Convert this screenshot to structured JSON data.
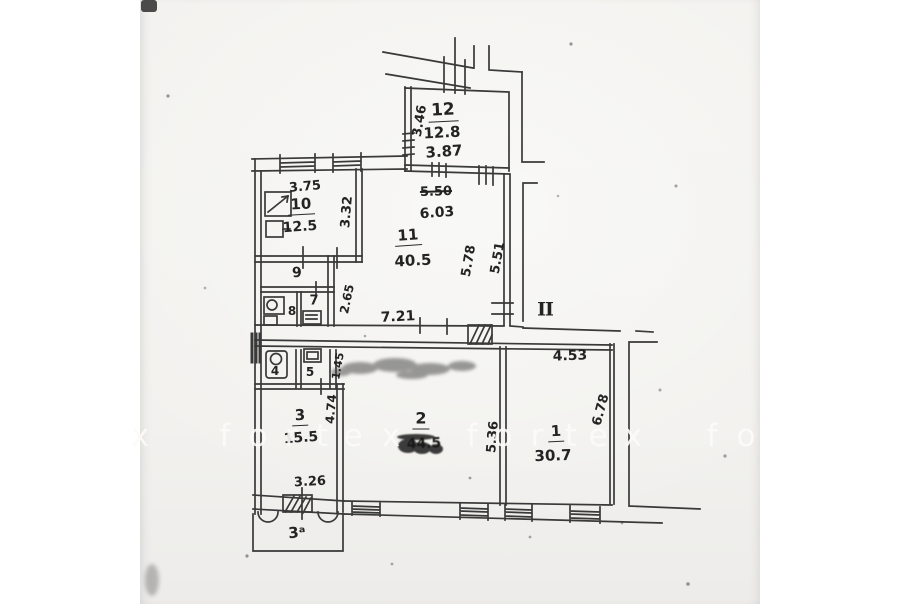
{
  "document": {
    "type_label": "apartment floor plan (scan)",
    "entrance_mark": "II",
    "balcony_mark": "3ᵃ"
  },
  "rooms": [
    {
      "number": "12",
      "area": "12.8"
    },
    {
      "number": "10",
      "area": "12.5"
    },
    {
      "number": "11",
      "area": "40.5"
    },
    {
      "number": "9",
      "area": ""
    },
    {
      "number": "8",
      "area": ""
    },
    {
      "number": "7",
      "area": ""
    },
    {
      "number": "4",
      "area": ""
    },
    {
      "number": "5",
      "area": ""
    },
    {
      "number": "3",
      "area": "15.5"
    },
    {
      "number": "2",
      "area": "44.5",
      "smudged": true
    },
    {
      "number": "1",
      "area": "30.7"
    }
  ],
  "plan": {
    "labels": [
      {
        "name": "dim-3-46",
        "text": "3.46",
        "x": 420,
        "y": 121,
        "rot": -80,
        "size": 13
      },
      {
        "name": "room-12-number",
        "text": "12",
        "x": 443,
        "y": 112,
        "rot": -3,
        "size": 17,
        "cls": "underline"
      },
      {
        "name": "room-12-area",
        "text": "12.8",
        "x": 442,
        "y": 133,
        "rot": -3,
        "size": 15
      },
      {
        "name": "dim-3-87",
        "text": "3.87",
        "x": 444,
        "y": 152,
        "rot": -4,
        "size": 15
      },
      {
        "name": "dim-5-50",
        "text": "5.50",
        "x": 436,
        "y": 192,
        "rot": -2,
        "size": 13,
        "cls": "strike"
      },
      {
        "name": "dim-6-03",
        "text": "6.03",
        "x": 437,
        "y": 213,
        "rot": -4,
        "size": 14
      },
      {
        "name": "dim-3-75",
        "text": "3.75",
        "x": 305,
        "y": 187,
        "rot": -5,
        "size": 13
      },
      {
        "name": "room-10-number",
        "text": "10",
        "x": 301,
        "y": 206,
        "rot": -3,
        "size": 15,
        "cls": "underline"
      },
      {
        "name": "room-10-area",
        "text": "12.5",
        "x": 300,
        "y": 227,
        "rot": -4,
        "size": 14
      },
      {
        "name": "dim-3-32",
        "text": "3.32",
        "x": 347,
        "y": 212,
        "rot": -85,
        "size": 13
      },
      {
        "name": "room-9-number",
        "text": "9",
        "x": 297,
        "y": 273,
        "rot": -5,
        "size": 14
      },
      {
        "name": "room-7-number",
        "text": "7",
        "x": 314,
        "y": 301,
        "rot": 0,
        "size": 13
      },
      {
        "name": "room-8-number",
        "text": "8",
        "x": 292,
        "y": 311,
        "rot": 0,
        "size": 12
      },
      {
        "name": "dim-2-65",
        "text": "2.65",
        "x": 347,
        "y": 299,
        "rot": -78,
        "size": 12
      },
      {
        "name": "room-11-number",
        "text": "11",
        "x": 408,
        "y": 237,
        "rot": -4,
        "size": 15,
        "cls": "underline"
      },
      {
        "name": "room-11-area",
        "text": "40.5",
        "x": 413,
        "y": 261,
        "rot": -3,
        "size": 15
      },
      {
        "name": "dim-5-78",
        "text": "5.78",
        "x": 469,
        "y": 261,
        "rot": -80,
        "size": 13
      },
      {
        "name": "dim-5-51",
        "text": "5.51",
        "x": 498,
        "y": 258,
        "rot": -80,
        "size": 13
      },
      {
        "name": "dim-7-21",
        "text": "7.21",
        "x": 398,
        "y": 317,
        "rot": -3,
        "size": 14
      },
      {
        "name": "entrance-ii-label",
        "text": "II",
        "x": 545,
        "y": 310,
        "rot": 0,
        "size": 19,
        "cls": "serif"
      },
      {
        "name": "dim-4-53",
        "text": "4.53",
        "x": 570,
        "y": 356,
        "rot": -2,
        "size": 14
      },
      {
        "name": "room-1-number",
        "text": "1",
        "x": 556,
        "y": 433,
        "rot": -3,
        "size": 15,
        "cls": "underline"
      },
      {
        "name": "room-1-area",
        "text": "30.7",
        "x": 553,
        "y": 456,
        "rot": -2,
        "size": 15
      },
      {
        "name": "dim-6-78",
        "text": "6.78",
        "x": 601,
        "y": 410,
        "rot": -75,
        "size": 13
      },
      {
        "name": "dim-5-36",
        "text": "5.36",
        "x": 493,
        "y": 437,
        "rot": -85,
        "size": 13
      },
      {
        "name": "room-2-number",
        "text": "2",
        "x": 421,
        "y": 420,
        "rot": 0,
        "size": 16,
        "cls": "underline"
      },
      {
        "name": "room-2-area",
        "text": "44.5",
        "x": 424,
        "y": 444,
        "rot": -2,
        "size": 14,
        "cls": "blotted"
      },
      {
        "name": "room-3-number",
        "text": "3",
        "x": 300,
        "y": 417,
        "rot": -3,
        "size": 15,
        "cls": "underline"
      },
      {
        "name": "room-3-area",
        "text": "15.5",
        "x": 301,
        "y": 438,
        "rot": -4,
        "size": 14
      },
      {
        "name": "dim-4-74",
        "text": "4.74",
        "x": 331,
        "y": 409,
        "rot": -85,
        "size": 12
      },
      {
        "name": "dim-1-45",
        "text": "1.45",
        "x": 338,
        "y": 366,
        "rot": -80,
        "size": 11
      },
      {
        "name": "dim-3-26",
        "text": "3.26",
        "x": 310,
        "y": 482,
        "rot": -3,
        "size": 13
      },
      {
        "name": "balcony-label",
        "text": "3ᵃ",
        "x": 297,
        "y": 533,
        "rot": -5,
        "size": 15
      },
      {
        "name": "room-4-number",
        "text": "4",
        "x": 275,
        "y": 371,
        "rot": 0,
        "size": 12
      },
      {
        "name": "room-5-number",
        "text": "5",
        "x": 310,
        "y": 372,
        "rot": 0,
        "size": 12
      }
    ]
  },
  "watermark": {
    "text": "fortex",
    "letters": [
      {
        "ch": "x",
        "x": 140
      },
      {
        "ch": "f",
        "x": 225
      },
      {
        "ch": "o",
        "x": 258
      },
      {
        "ch": "r",
        "x": 291
      },
      {
        "ch": "t",
        "x": 322
      },
      {
        "ch": "e",
        "x": 353
      },
      {
        "ch": "x",
        "x": 391
      },
      {
        "ch": "f",
        "x": 472
      },
      {
        "ch": "o",
        "x": 503
      },
      {
        "ch": "r",
        "x": 537
      },
      {
        "ch": "t",
        "x": 571
      },
      {
        "ch": "e",
        "x": 598
      },
      {
        "ch": "x",
        "x": 633
      },
      {
        "ch": "f",
        "x": 712
      },
      {
        "ch": "o",
        "x": 746
      }
    ]
  },
  "colors": {
    "ink": "#2a2a2a",
    "paper": "#f2f1ee",
    "margin": "#ffffff",
    "watermark": "#fcfbf8"
  }
}
